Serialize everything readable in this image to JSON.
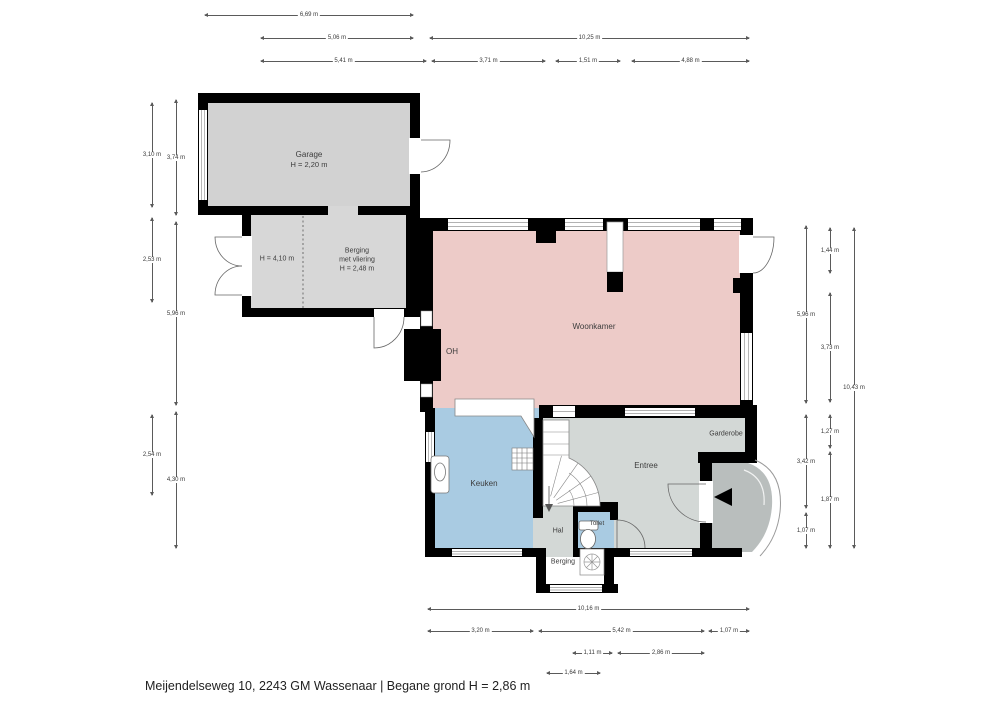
{
  "meta": {
    "caption": "Meijendelseweg 10, 2243 GM Wassenaar | Begane grond H = 2,86 m"
  },
  "rooms": {
    "garage": {
      "name": "Garage",
      "height": "H = 2,20 m"
    },
    "berging_left_height": "H = 4,10 m",
    "berging": {
      "name": "Berging",
      "line2": "met vliering",
      "height": "H = 2,48 m"
    },
    "woonkamer": {
      "name": "Woonkamer"
    },
    "oh": {
      "name": "OH"
    },
    "keuken": {
      "name": "Keuken"
    },
    "entree": {
      "name": "Entree"
    },
    "garderobe": {
      "name": "Garderobe"
    },
    "hal": {
      "name": "Hal"
    },
    "toilet": {
      "name": "Toilet"
    },
    "berging2": {
      "name": "Berging"
    }
  },
  "icons": {
    "stove": "stove-burner-icon",
    "sink": "sink-icon",
    "toilet": "toilet-bowl-icon",
    "ventilation": "fan-icon",
    "entrance": "entrance-arrow-icon",
    "stairs": "winder-stairs",
    "chimney": "chimney-block"
  },
  "colors": {
    "wall": "#000000",
    "garage": "#d2d2d2",
    "berging": "#d7d7d7",
    "woonkamer": "#edcbc8",
    "keuken": "#a9cbe2",
    "toilet": "#a9cbe2",
    "entree": "#d3d8d6",
    "berging2": "#ffffff",
    "porch": "#b9bebd",
    "dimension": "#5a5a5a"
  },
  "dimensions": [
    {
      "dir": "h",
      "a": 205,
      "b": 413,
      "p": 15,
      "label": "6,69 m"
    },
    {
      "dir": "h",
      "a": 261,
      "b": 413,
      "p": 38,
      "label": "5,06 m"
    },
    {
      "dir": "h",
      "a": 430,
      "b": 749,
      "p": 38,
      "label": "10,25 m"
    },
    {
      "dir": "h",
      "a": 261,
      "b": 426,
      "p": 61,
      "label": "5,41 m"
    },
    {
      "dir": "h",
      "a": 432,
      "b": 545,
      "p": 61,
      "label": "3,71 m"
    },
    {
      "dir": "h",
      "a": 556,
      "b": 620,
      "p": 61,
      "label": "1,51 m"
    },
    {
      "dir": "h",
      "a": 632,
      "b": 749,
      "p": 61,
      "label": "4,88 m"
    },
    {
      "dir": "v",
      "a": 103,
      "b": 207,
      "p": 152,
      "label": "3,10 m"
    },
    {
      "dir": "v",
      "a": 100,
      "b": 215,
      "p": 176,
      "label": "3,74 m"
    },
    {
      "dir": "v",
      "a": 218,
      "b": 302,
      "p": 152,
      "label": "2,53 m"
    },
    {
      "dir": "v",
      "a": 222,
      "b": 405,
      "p": 176,
      "label": "5,96 m"
    },
    {
      "dir": "v",
      "a": 415,
      "b": 495,
      "p": 152,
      "label": "2,54 m"
    },
    {
      "dir": "v",
      "a": 412,
      "b": 548,
      "p": 176,
      "label": "4,30 m"
    },
    {
      "dir": "v",
      "a": 226,
      "b": 403,
      "p": 806,
      "label": "5,96 m"
    },
    {
      "dir": "v",
      "a": 415,
      "b": 508,
      "p": 806,
      "label": "3,42 m"
    },
    {
      "dir": "v",
      "a": 513,
      "b": 548,
      "p": 806,
      "label": "1,07 m"
    },
    {
      "dir": "v",
      "a": 228,
      "b": 273,
      "p": 830,
      "label": "1,44 m"
    },
    {
      "dir": "v",
      "a": 293,
      "b": 402,
      "p": 830,
      "label": "3,73 m"
    },
    {
      "dir": "v",
      "a": 415,
      "b": 448,
      "p": 830,
      "label": "1,27 m"
    },
    {
      "dir": "v",
      "a": 452,
      "b": 548,
      "p": 830,
      "label": "1,87 m"
    },
    {
      "dir": "v",
      "a": 228,
      "b": 548,
      "p": 854,
      "label": "10,43 m"
    },
    {
      "dir": "h",
      "a": 428,
      "b": 749,
      "p": 609,
      "label": "10,16 m"
    },
    {
      "dir": "h",
      "a": 428,
      "b": 533,
      "p": 631,
      "label": "3,20 m"
    },
    {
      "dir": "h",
      "a": 539,
      "b": 704,
      "p": 631,
      "label": "5,42 m"
    },
    {
      "dir": "h",
      "a": 709,
      "b": 749,
      "p": 631,
      "label": "1,07 m"
    },
    {
      "dir": "h",
      "a": 573,
      "b": 612,
      "p": 653,
      "label": "1,11 m"
    },
    {
      "dir": "h",
      "a": 618,
      "b": 704,
      "p": 653,
      "label": "2,86 m"
    },
    {
      "dir": "h",
      "a": 547,
      "b": 600,
      "p": 673,
      "label": "1,64 m"
    }
  ]
}
